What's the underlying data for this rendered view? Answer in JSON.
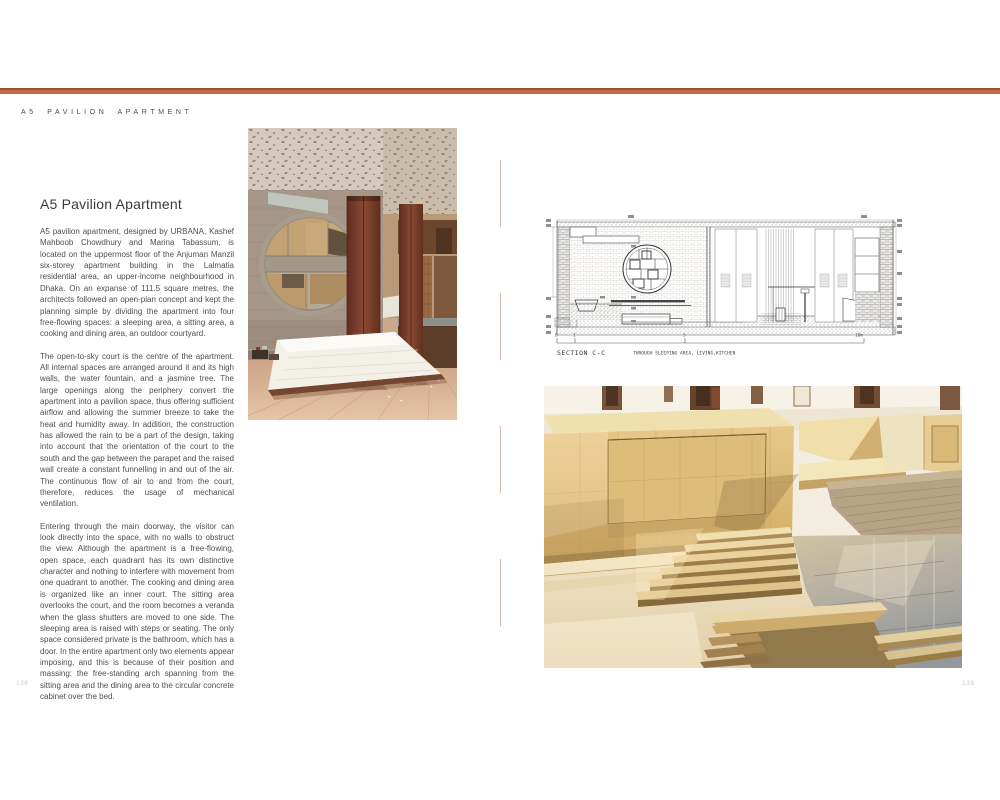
{
  "page": {
    "header_title": "A5 PAVILION APARTMENT",
    "page_number_left": "138",
    "page_number_right": "139"
  },
  "article": {
    "title": "A5 Pavilion Apartment",
    "paragraphs": [
      "A5 pavilion apartment, designed by URBANA, Kashef Mahboob Chowdhury and Marina Tabassum, is located on the uppermost floor of the Anjuman Manzil six-storey apartment building in the Lalmatia residential area, an upper-income neighbourhood in Dhaka. On an expanse of 111.5 square metres, the architects followed an open-plan concept and kept the planning simple by dividing the apartment into four free-flowing spaces: a sleeping area, a sitting area, a cooking and dining area, an outdoor courtyard.",
      "The open-to-sky court is the centre of the apartment. All internal spaces are arranged around it and its high walls, the water fountain, and a jasmine tree. The large openings along the periphery convert the apartment into a pavilion space, thus offering sufficient airflow and allowing the summer breeze to take the heat and humidity away. In addition, the construction has allowed the rain to be a part of the design, taking into account that the orientation of the court to the south and the gap between the parapet and the raised wall create a constant funnelling in and out of the air. The continuous flow of air to and from the court, therefore, reduces the usage of mechanical ventilation.",
      "Entering through the main doorway, the visitor can look directly into the space, with no walls to obstruct the view. Although the apartment is a free-flowing, open space, each quadrant has its own distinctive character and nothing to interfere with movement from one quadrant to another. The cooking and dining area is organized like an inner court. The sitting area overlooks the court, and the room becomes a veranda when the glass shutters are moved to one side. The sleeping area is raised with steps or seating. The only space considered private is the bathroom, which has a door. In the entire apartment only two elements appear imposing, and this is because of their position and massing: the free-standing arch spanning from the sitting area and the dining area to the circular concrete cabinet over the bed."
    ]
  },
  "drawing": {
    "caption_title": "SECTION C-C",
    "caption_subtitle": "THROUGH SLEEPING AREA, LIVING,KITCHEN",
    "scale_labels": [
      "0",
      "1",
      "5",
      "10m"
    ]
  },
  "photos": {
    "top_photo": "Interior: perforated concrete ceiling, circular concrete cabinet, timber shutters, low bed",
    "bottom_photo": "Open-to-sky stone courtyard with stepped travertine blocks and reflecting water"
  },
  "colors": {
    "accent_bar": "#bd6945",
    "divider": "#d9b8ab"
  }
}
